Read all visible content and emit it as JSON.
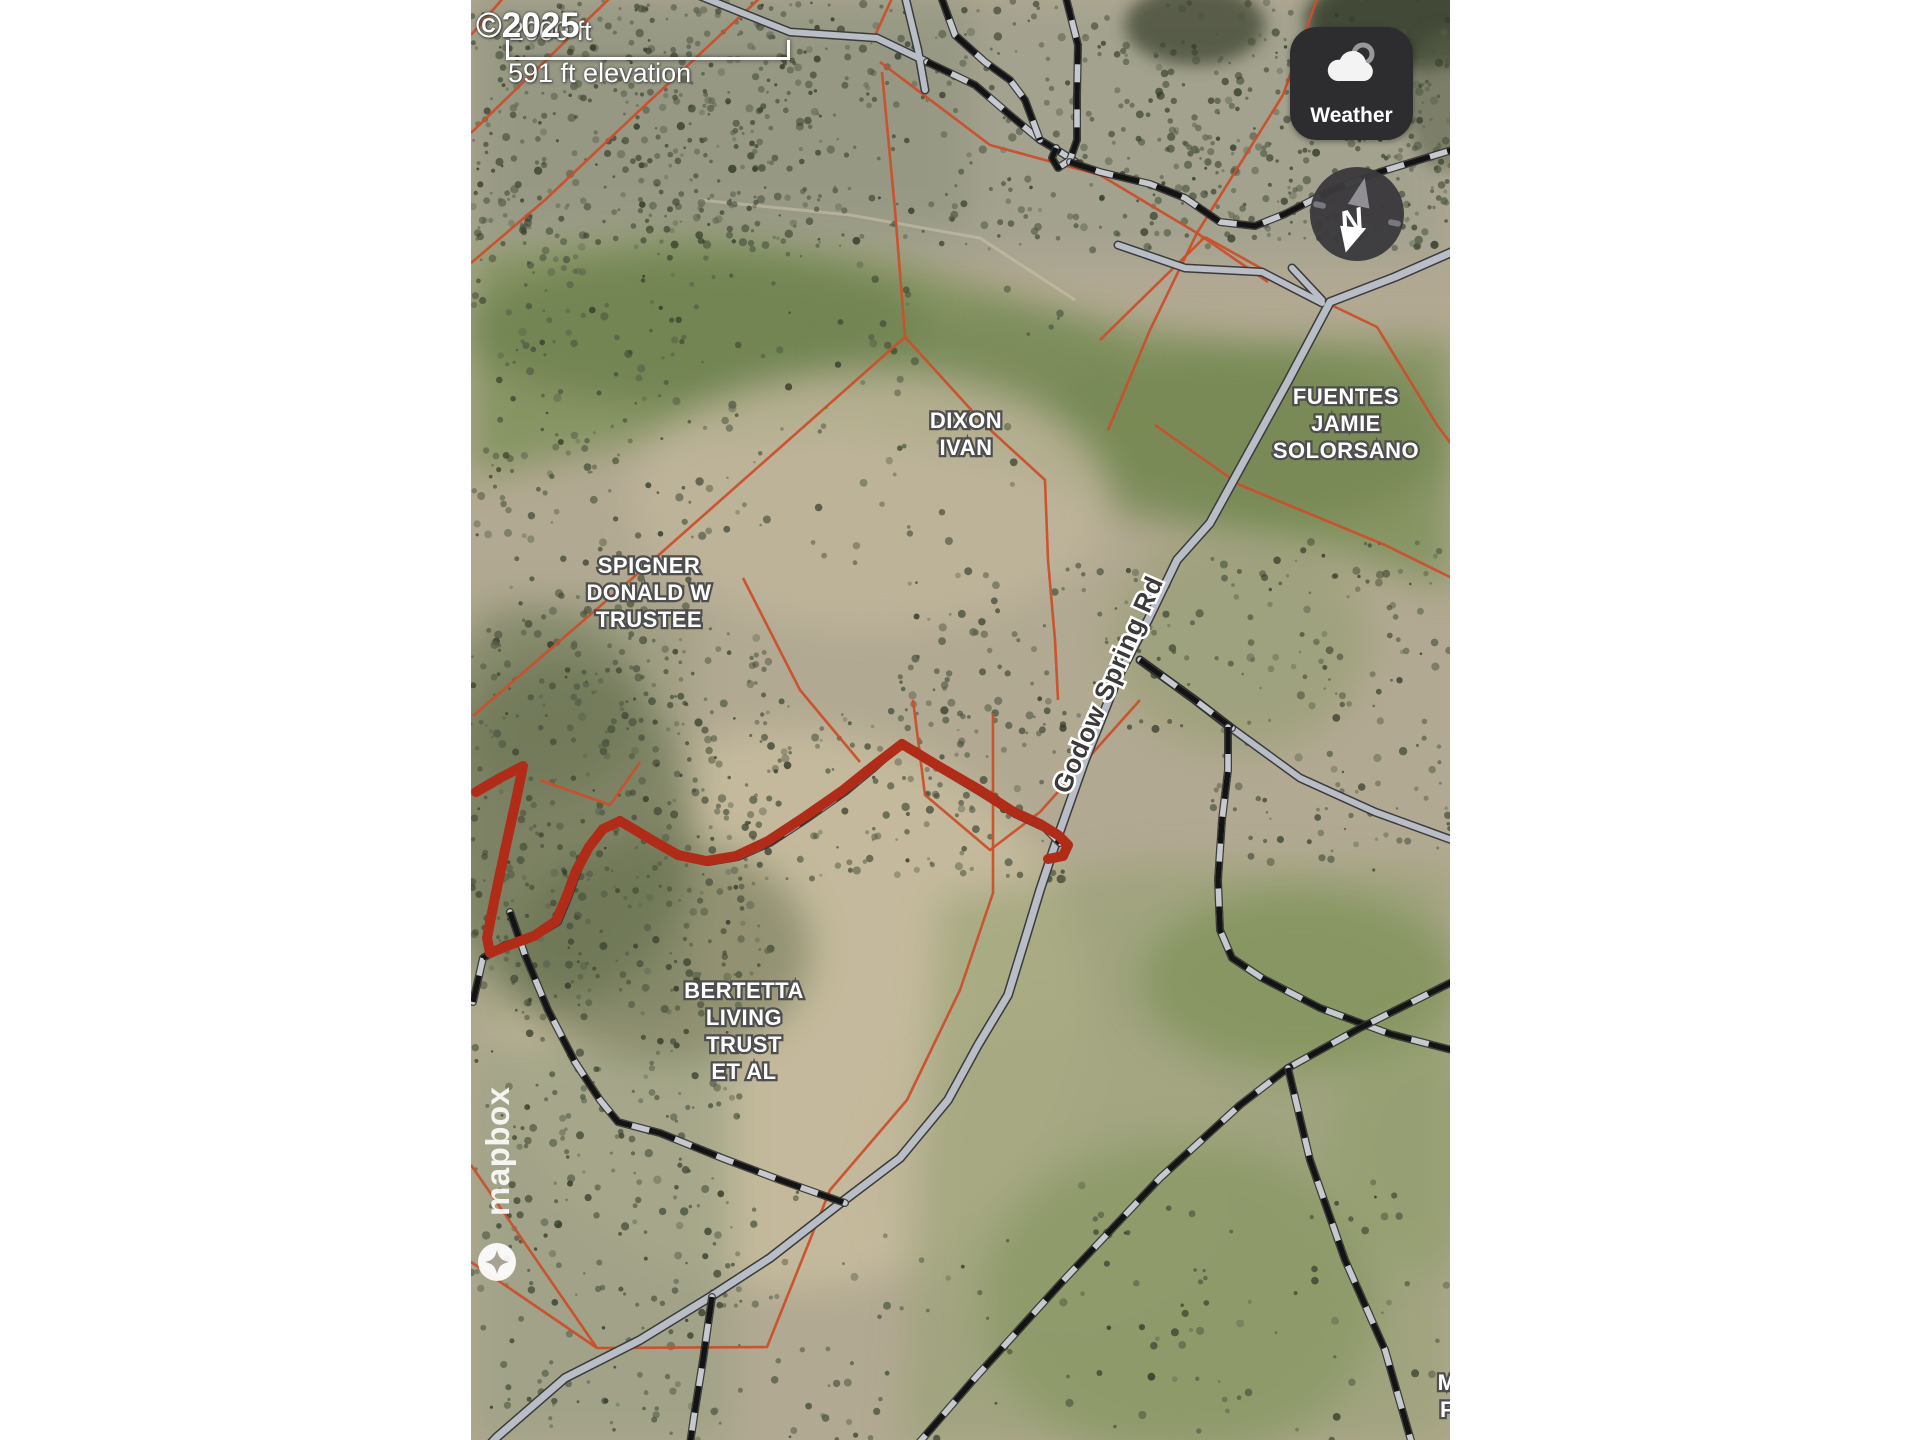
{
  "map_ui": {
    "attribution": "©2025",
    "scale_label": "2000 ft",
    "elevation_label": "591 ft elevation",
    "weather_label": "Weather",
    "compass_north": "N",
    "brand": "mapbox"
  },
  "road_label": {
    "text": "Godow Spring Rd",
    "x": 1116,
    "y": 688,
    "angle": -66
  },
  "parcel_labels": [
    {
      "name": "dixon-ivan",
      "lines": [
        "DIXON",
        "IVAN"
      ],
      "x": 966,
      "y": 428
    },
    {
      "name": "fuentes-jamie-solorsano",
      "lines": [
        "FUENTES",
        "JAMIE",
        "SOLORSANO"
      ],
      "x": 1346,
      "y": 404
    },
    {
      "name": "spigner-donald-w-trustee",
      "lines": [
        "SPIGNER",
        "DONALD W",
        "TRUSTEE"
      ],
      "x": 649,
      "y": 573
    },
    {
      "name": "bertetta-living-trust-et-al",
      "lines": [
        "BERTETTA",
        "LIVING",
        "TRUST",
        "ET AL"
      ],
      "x": 744,
      "y": 998
    },
    {
      "name": "clipped-owner-label",
      "lines": [
        "M",
        "F"
      ],
      "x": 1447,
      "y": 1390
    }
  ],
  "colors": {
    "parcel": "#cb4f2b",
    "redTrail": "#b02c18",
    "roadFill": "#b8bdc6",
    "roadCasing": "#3b3b3b",
    "trailDash": "#131313",
    "trailBase": "#c6cad0",
    "labelFill": "#ffffff",
    "labelHalo": "#4e4e4e",
    "roadLabelFill": "#3a3a3a",
    "panel": "#2d2c2e"
  }
}
